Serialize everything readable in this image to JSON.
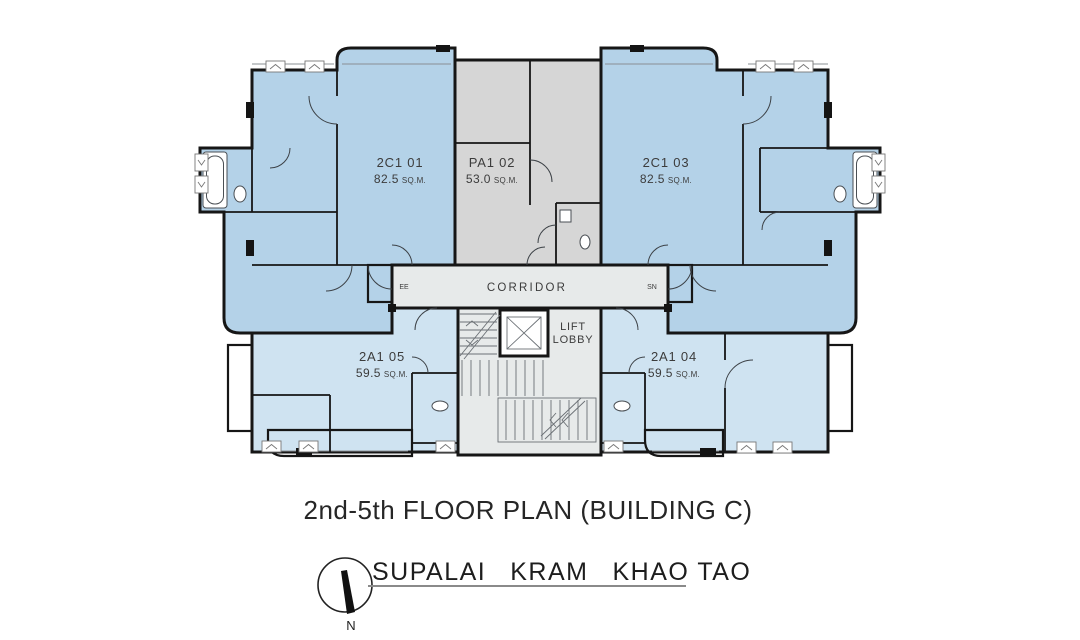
{
  "title": "2nd-5th FLOOR PLAN (BUILDING C)",
  "project": {
    "name_word1": "SUPALAI",
    "name_word2": "KRAM",
    "name_word3": "KHAO TAO",
    "compass_north_label": "N"
  },
  "plan": {
    "labels": {
      "corridor": "CORRIDOR",
      "lift_line1": "LIFT",
      "lift_line2": "LOBBY",
      "ee": "EE",
      "sn": "SN"
    },
    "units": [
      {
        "code": "2C1 01",
        "area_value": "82.5",
        "area_unit": "SQ.M.",
        "fill": "#b4d2e8"
      },
      {
        "code": "PA1 02",
        "area_value": "53.0",
        "area_unit": "SQ.M.",
        "fill": "#d6d6d6"
      },
      {
        "code": "2C1 03",
        "area_value": "82.5",
        "area_unit": "SQ.M.",
        "fill": "#b4d2e8"
      },
      {
        "code": "2A1 05",
        "area_value": "59.5",
        "area_unit": "SQ.M.",
        "fill": "#cfe3f1"
      },
      {
        "code": "2A1 04",
        "area_value": "59.5",
        "area_unit": "SQ.M.",
        "fill": "#cfe3f1"
      }
    ],
    "colors": {
      "unit_blue": "#b4d2e8",
      "unit_light_blue": "#cfe3f1",
      "unit_grey": "#d6d6d6",
      "core_grey": "#e7eaea",
      "wall": "#161616"
    }
  }
}
